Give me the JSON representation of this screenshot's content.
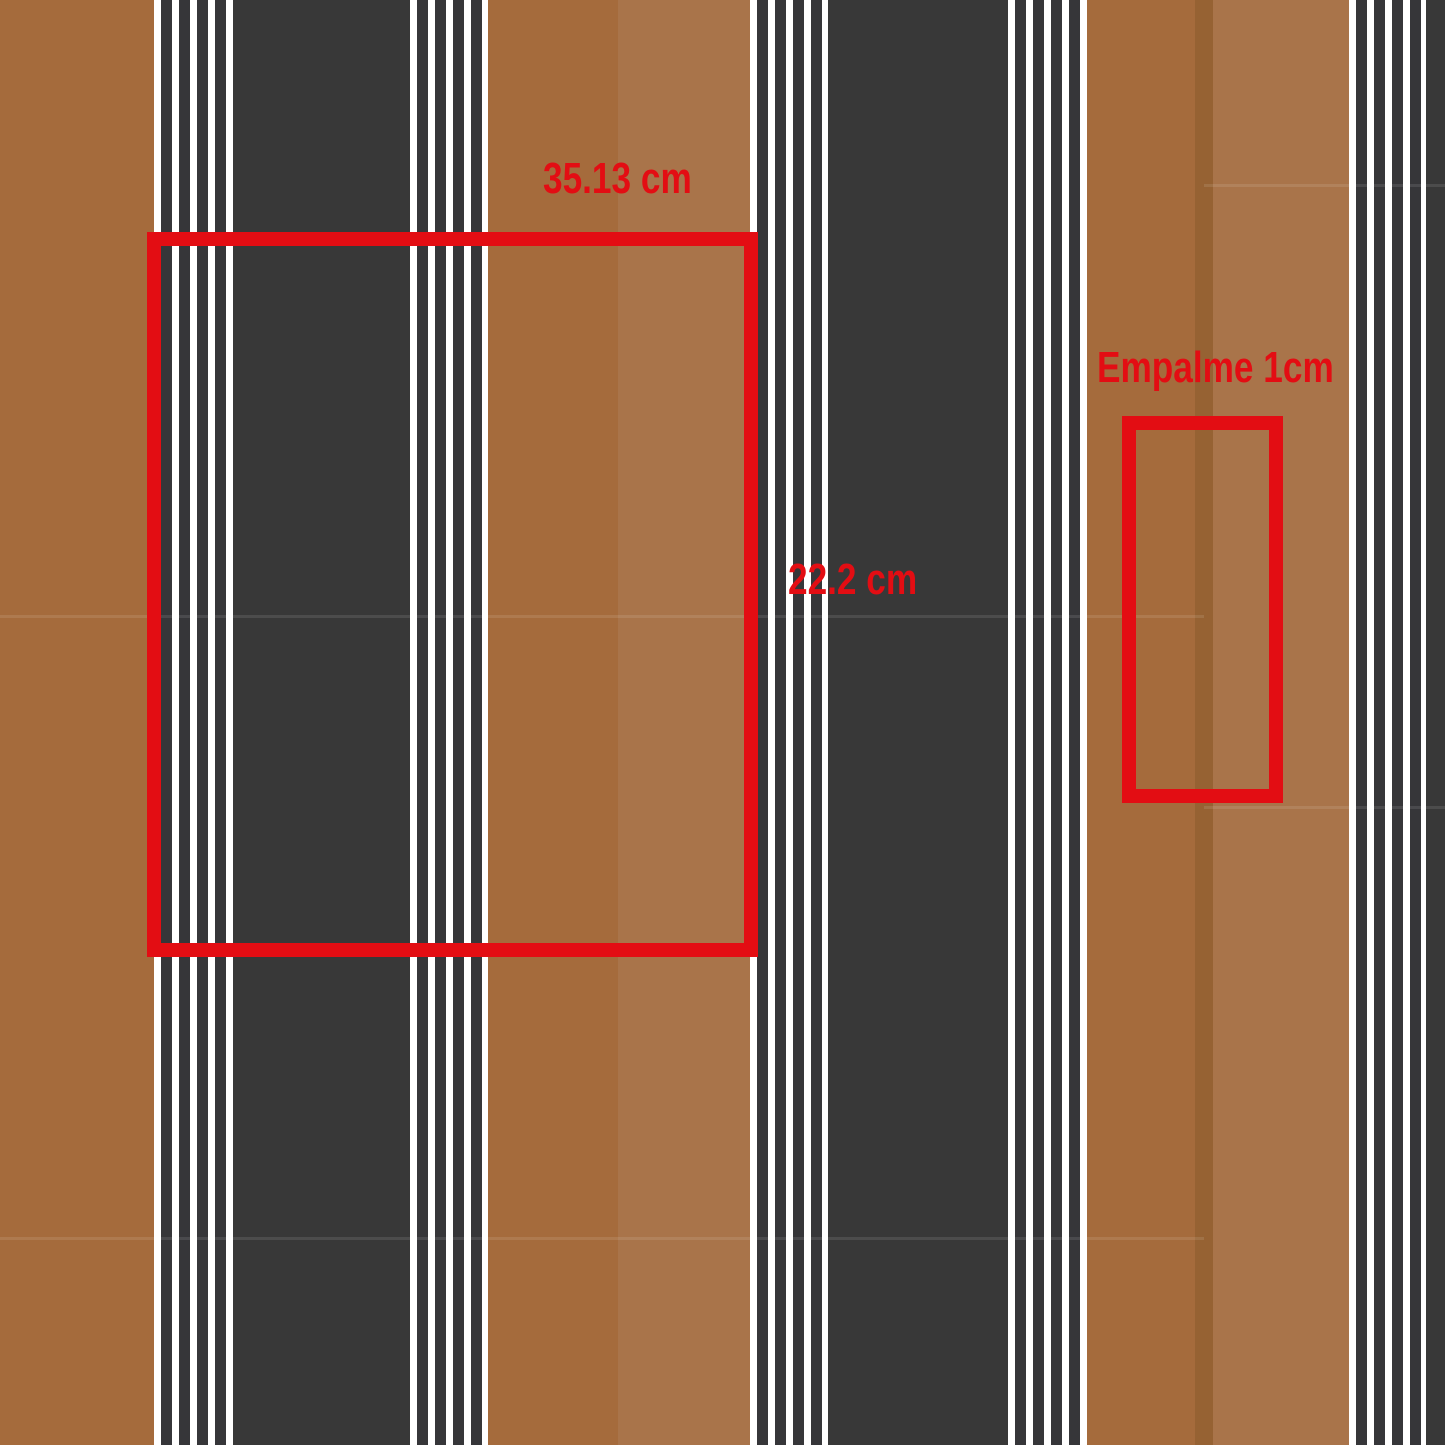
{
  "canvas": {
    "width_px": 1445,
    "height_px": 1445
  },
  "colors": {
    "brown_dark": "#a56b3c",
    "brown_light": "#a9744a",
    "brown_overlap": "#966233",
    "charcoal": "#383838",
    "pin_dark": "#363639",
    "pin_white": "#ffffff",
    "red": "#e30d13"
  },
  "pinstripes": {
    "white_px": 7,
    "dark_px": 11,
    "dark_stripe_count": 4
  },
  "stripes": [
    {
      "name": "brown-band-left",
      "fill": "brown_dark",
      "x": 0,
      "w": 154
    },
    {
      "name": "pinstripe-group-1",
      "fill": "pinstripes",
      "x": 154,
      "w": 79
    },
    {
      "name": "charcoal-band-1",
      "fill": "charcoal",
      "x": 233,
      "w": 177
    },
    {
      "name": "pinstripe-group-2",
      "fill": "pinstripes",
      "x": 410,
      "w": 78
    },
    {
      "name": "brown-dark-half-1",
      "fill": "brown_dark",
      "x": 488,
      "w": 130
    },
    {
      "name": "brown-light-half-1",
      "fill": "brown_light",
      "x": 618,
      "w": 132
    },
    {
      "name": "pinstripe-group-3",
      "fill": "pinstripes",
      "x": 750,
      "w": 78
    },
    {
      "name": "charcoal-band-2",
      "fill": "charcoal",
      "x": 828,
      "w": 180
    },
    {
      "name": "pinstripe-group-4",
      "fill": "pinstripes",
      "x": 1008,
      "w": 79
    },
    {
      "name": "brown-dark-half-2",
      "fill": "brown_dark",
      "x": 1087,
      "w": 108
    },
    {
      "name": "splice-overlap-strip",
      "fill": "brown_overlap",
      "x": 1195,
      "w": 18
    },
    {
      "name": "brown-light-half-2",
      "fill": "brown_light",
      "x": 1213,
      "w": 136
    },
    {
      "name": "pinstripe-group-5",
      "fill": "pinstripes",
      "x": 1349,
      "w": 77
    },
    {
      "name": "charcoal-band-right",
      "fill": "charcoal",
      "x": 1426,
      "w": 19
    }
  ],
  "seams": [
    {
      "name": "repeat-seam-left-1",
      "x": 0,
      "y": 615,
      "w": 1204,
      "h": 3
    },
    {
      "name": "repeat-seam-left-2",
      "x": 0,
      "y": 1237,
      "w": 1204,
      "h": 3
    },
    {
      "name": "repeat-seam-right-1",
      "x": 1204,
      "y": 184,
      "w": 241,
      "h": 3
    },
    {
      "name": "repeat-seam-right-2",
      "x": 1204,
      "y": 806,
      "w": 241,
      "h": 3
    }
  ],
  "annotations": {
    "repeat": {
      "width_label": "35.13 cm",
      "height_label": "22.2 cm",
      "rect": {
        "x": 147,
        "y": 232,
        "w": 611,
        "h": 725
      },
      "width_label_pos": {
        "x": 543,
        "y": 157
      },
      "height_label_pos": {
        "x": 788,
        "y": 558
      }
    },
    "splice": {
      "label": "Empalme 1cm",
      "rect": {
        "x": 1122,
        "y": 416,
        "w": 161,
        "h": 387
      },
      "label_pos": {
        "x": 1097,
        "y": 346
      }
    }
  }
}
